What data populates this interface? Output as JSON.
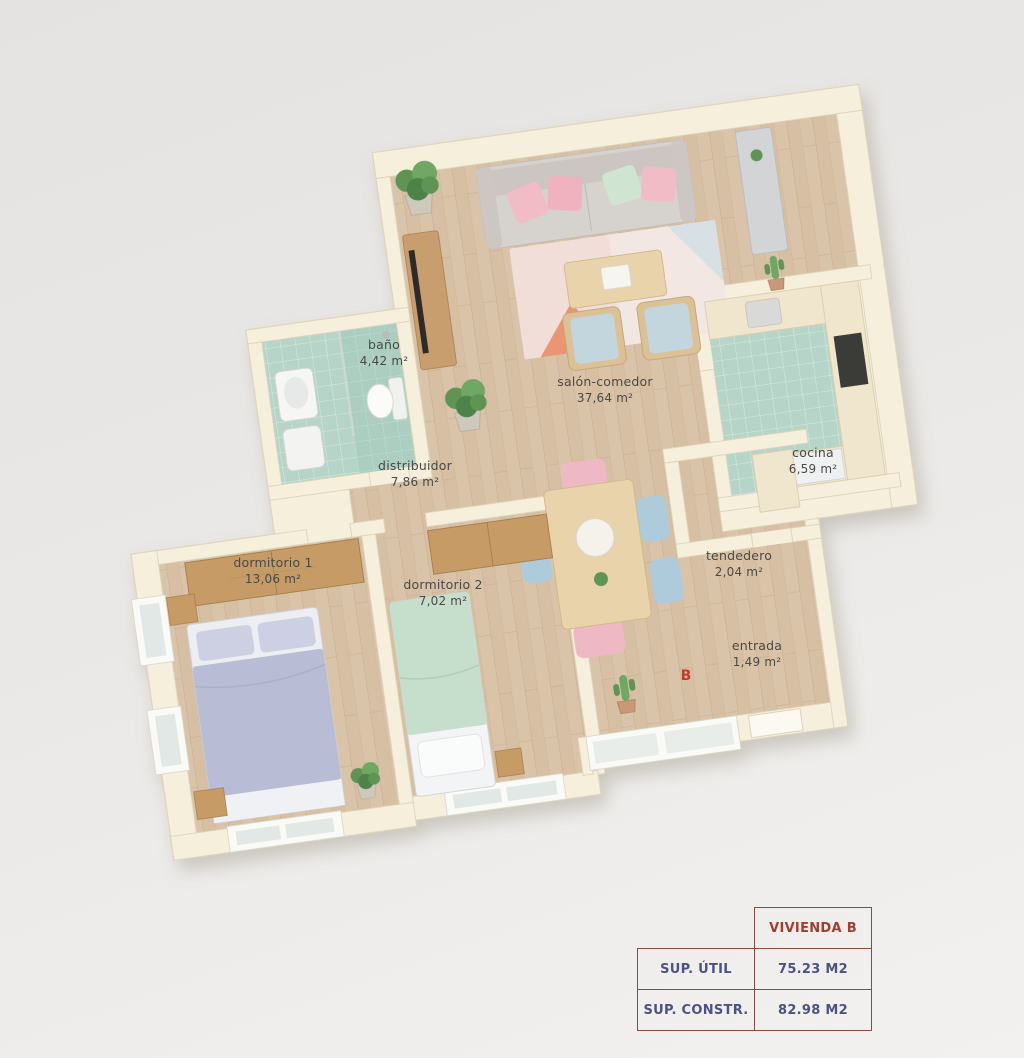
{
  "floor_plan": {
    "rotation_deg": -8,
    "rooms": [
      {
        "id": "salon-comedor",
        "label": "salón-comedor",
        "area": "37,64 m²"
      },
      {
        "id": "bano",
        "label": "baño",
        "area": "4,42 m²"
      },
      {
        "id": "distribuidor",
        "label": "distribuidor",
        "area": "7,86 m²"
      },
      {
        "id": "cocina",
        "label": "cocina",
        "area": "6,59 m²"
      },
      {
        "id": "dormitorio-1",
        "label": "dormitorio 1",
        "area": "13,06 m²"
      },
      {
        "id": "dormitorio-2",
        "label": "dormitorio 2",
        "area": "7,02 m²"
      },
      {
        "id": "tendedero",
        "label": "tendedero",
        "area": "2,04 m²"
      },
      {
        "id": "entrada",
        "label": "entrada",
        "area": "1,49 m²"
      }
    ],
    "unit_marker": {
      "text": "B",
      "color": "#c23b2d"
    },
    "palette": {
      "wall": "#f5efdc",
      "wood_floor": "#dac4a9",
      "tile_floor": "#b6d5c8",
      "sofa_grey": "#d6d2ce",
      "pillow_pink": "#f2bcc6",
      "pillow_green": "#cfe5d2",
      "bed1_lavender": "#b8bcd5",
      "bed2_green": "#c6dfcc",
      "furniture_wood": "#c69b66",
      "chair_blue": "#aecbdc",
      "chair_pink": "#eeb9c4",
      "plant_green": "#5f9454",
      "appliance_dark": "#3a3a38"
    }
  },
  "info_table": {
    "header": "VIVIENDA B",
    "rows": [
      {
        "label": "SUP. ÚTIL",
        "value": "75.23 M2"
      },
      {
        "label": "SUP. CONSTR.",
        "value": "82.98 M2"
      }
    ],
    "colors": {
      "border": "#8d4a3c",
      "header_text": "#a33d30",
      "body_text": "#4a5382"
    }
  }
}
